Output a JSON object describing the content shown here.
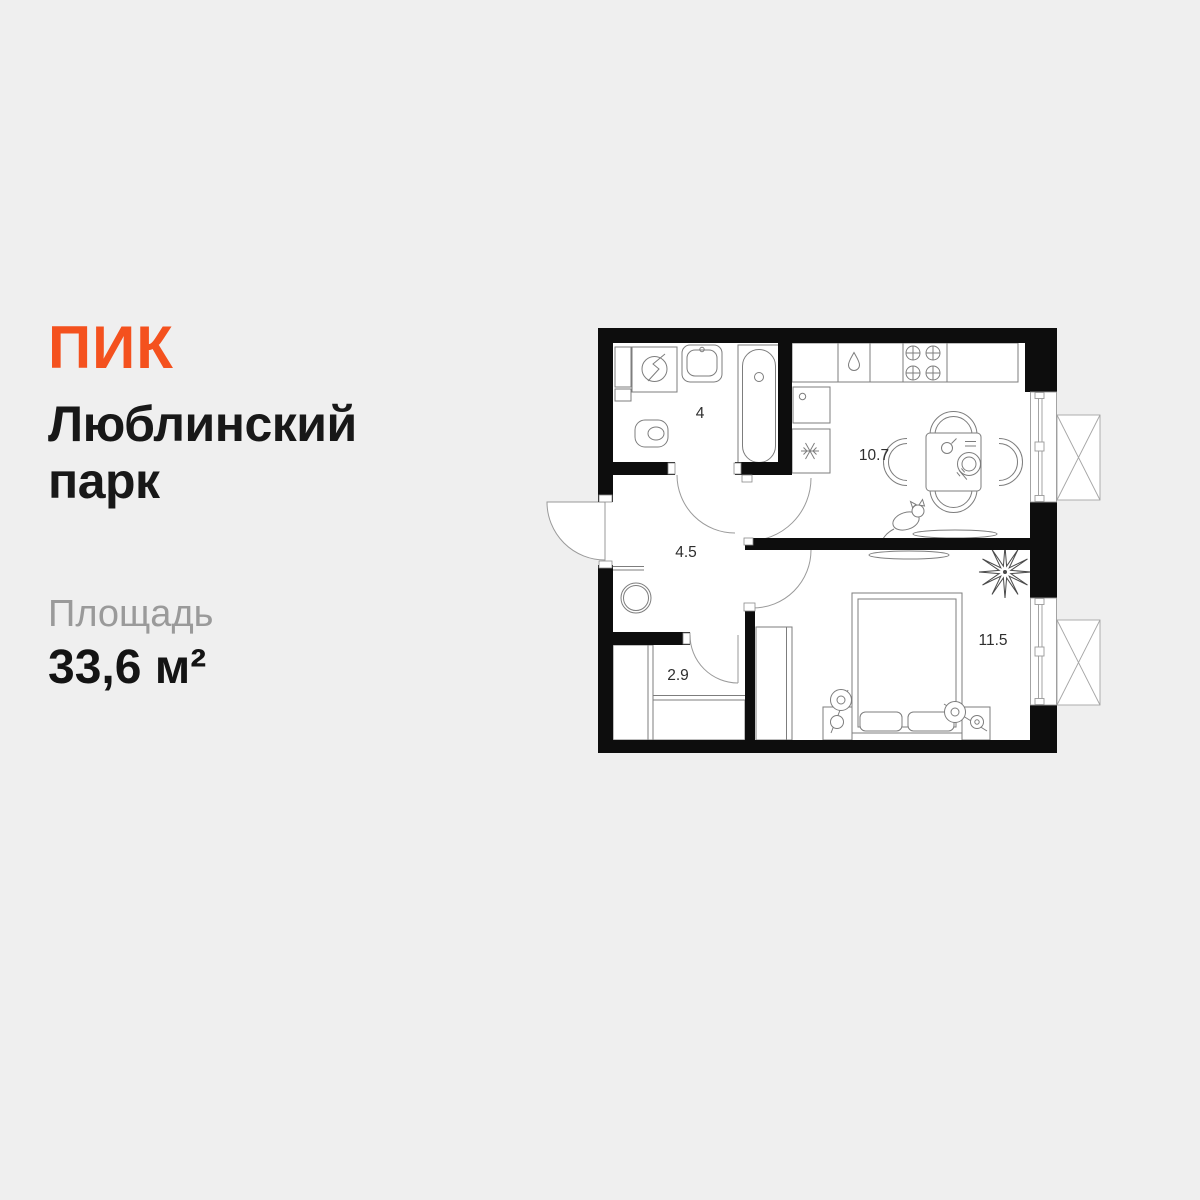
{
  "brand": {
    "logo_text": "ПИК",
    "logo_color": "#F4511E"
  },
  "listing": {
    "project_name": "Люблинский парк",
    "area_label": "Площадь",
    "area_value": "33,6 м²"
  },
  "floor_plan": {
    "type": "apartment-floor-plan",
    "rooms": [
      {
        "id": "bathroom",
        "area_label": "4"
      },
      {
        "id": "hallway",
        "area_label": "4.5"
      },
      {
        "id": "wardrobe-room",
        "area_label": "2.9"
      },
      {
        "id": "kitchen-living-room",
        "area_label": "10.7"
      },
      {
        "id": "bedroom",
        "area_label": "11.5"
      }
    ],
    "colors": {
      "page_background": "#EFEFEF",
      "room_fill": "#FFFFFF",
      "wall": "#0D0D0D",
      "furniture_line": "#7D7D7D",
      "door_line": "#9A9A9A",
      "label_text": "#2E2E2E"
    }
  }
}
